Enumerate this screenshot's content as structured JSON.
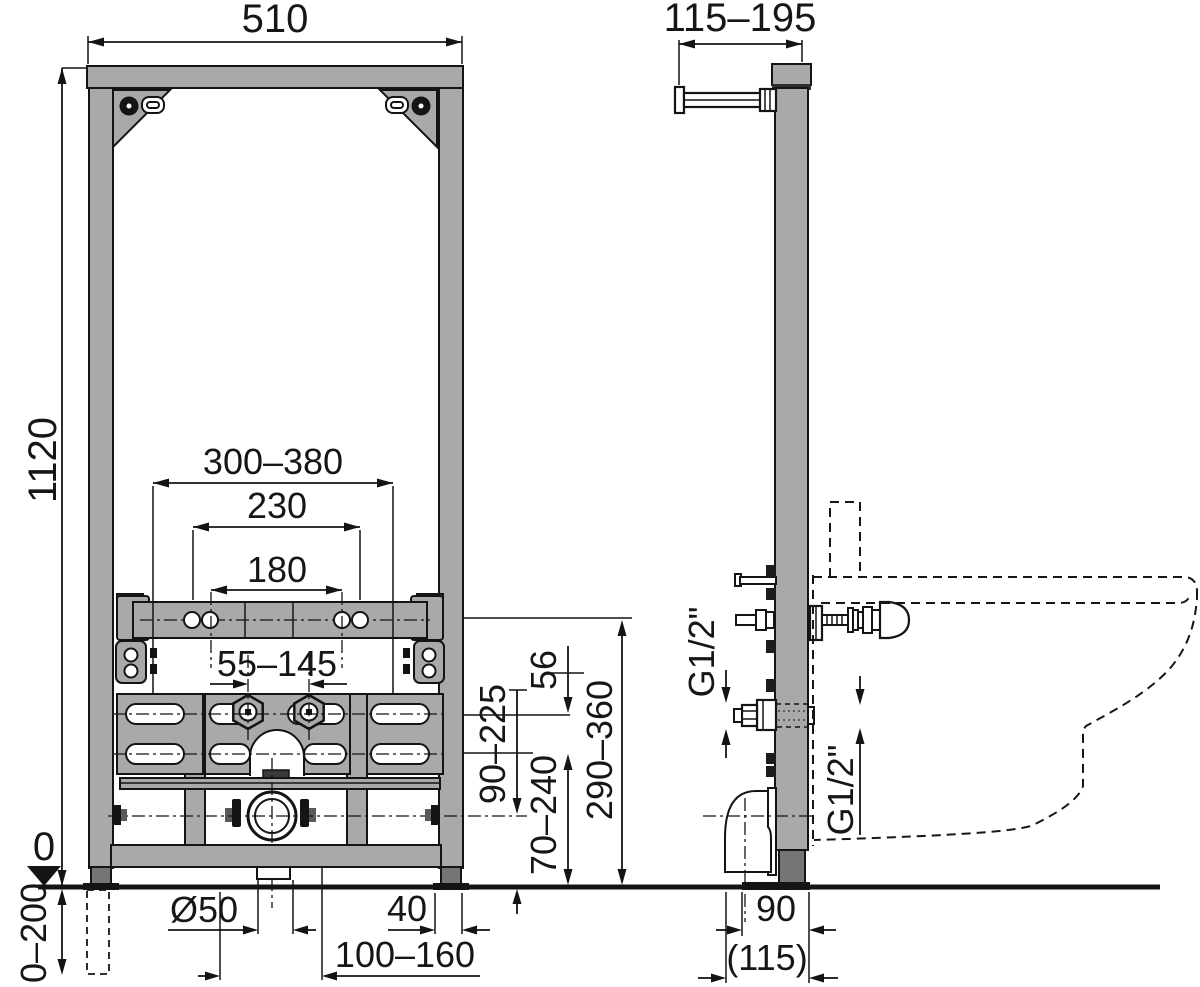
{
  "drawing_title": "Bidet installation frame technical drawing",
  "front": {
    "width": "510",
    "height": "1120",
    "rail_range": "300–380",
    "holes_outer": "230",
    "holes_inner": "180",
    "water_range": "55–145",
    "drain_height_range": "90–225",
    "offset_56": "56",
    "range_70_240": "70–240",
    "range_290_360": "290–360",
    "drain_diameter": "Ø50",
    "foot_width": "40",
    "drain_offset_range": "100–160",
    "floor_level": "0",
    "leg_extension": "0–200"
  },
  "side": {
    "depth_range": "115–195",
    "water_thread_left": "G1/2\"",
    "water_thread_right": "G1/2\"",
    "drain_wall_distance": "90",
    "drain_wall_distance_alt": "(115)"
  }
}
